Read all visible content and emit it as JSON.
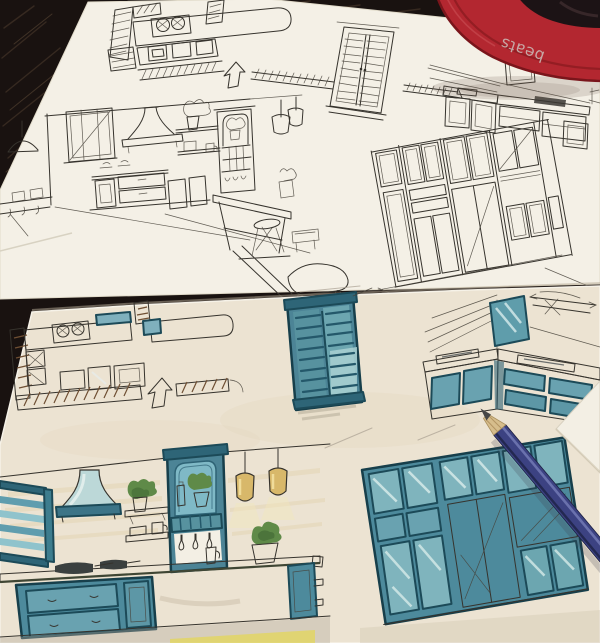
{
  "image": {
    "type": "photograph",
    "subject": "Hand-drawn kitchen interior design sketches in ink and marker on two stacked paper sheets, with a red beats headphone case and a blue drawing pencil on a dark wood table"
  },
  "beats_case": {
    "label": "beats",
    "brand_color": "#b32730",
    "inner_color": "#1c1315"
  },
  "pencil": {
    "body_color": "#3c4282",
    "wood_color": "#d6bd8c",
    "tip_color": "#474747"
  },
  "palette": {
    "table_wood": "#191210",
    "paper_top": "#f4f0e6",
    "paper_bottom": "#ece3d2",
    "ink": "#36332d",
    "marker_teal": "#4d8a9c",
    "marker_teal_dark": "#2a5d6f",
    "marker_teal_light": "#8fc3cc",
    "marker_yellow": "#e0d68c",
    "marker_brown": "#a57d52",
    "marker_green": "#5f8a48",
    "pendant_tan": "#d8b86a",
    "terracotta": "#c07a3f",
    "accent_red": "#b34a33"
  },
  "sketches": {
    "top_sheet_items": [
      "kitchen floor plan",
      "louvered window elevation",
      "kitchen wall elevation with hood and hutch",
      "corner kitchen perspective",
      "tall cabinet wall elevation",
      "bench perspective study"
    ],
    "bottom_sheet_items": [
      "colored kitchen floor plan",
      "colored louvered window",
      "colored corner kitchen perspective",
      "colored kitchen elevation with hood shelves and hutch",
      "colored tall cabinet wall elevation"
    ]
  }
}
